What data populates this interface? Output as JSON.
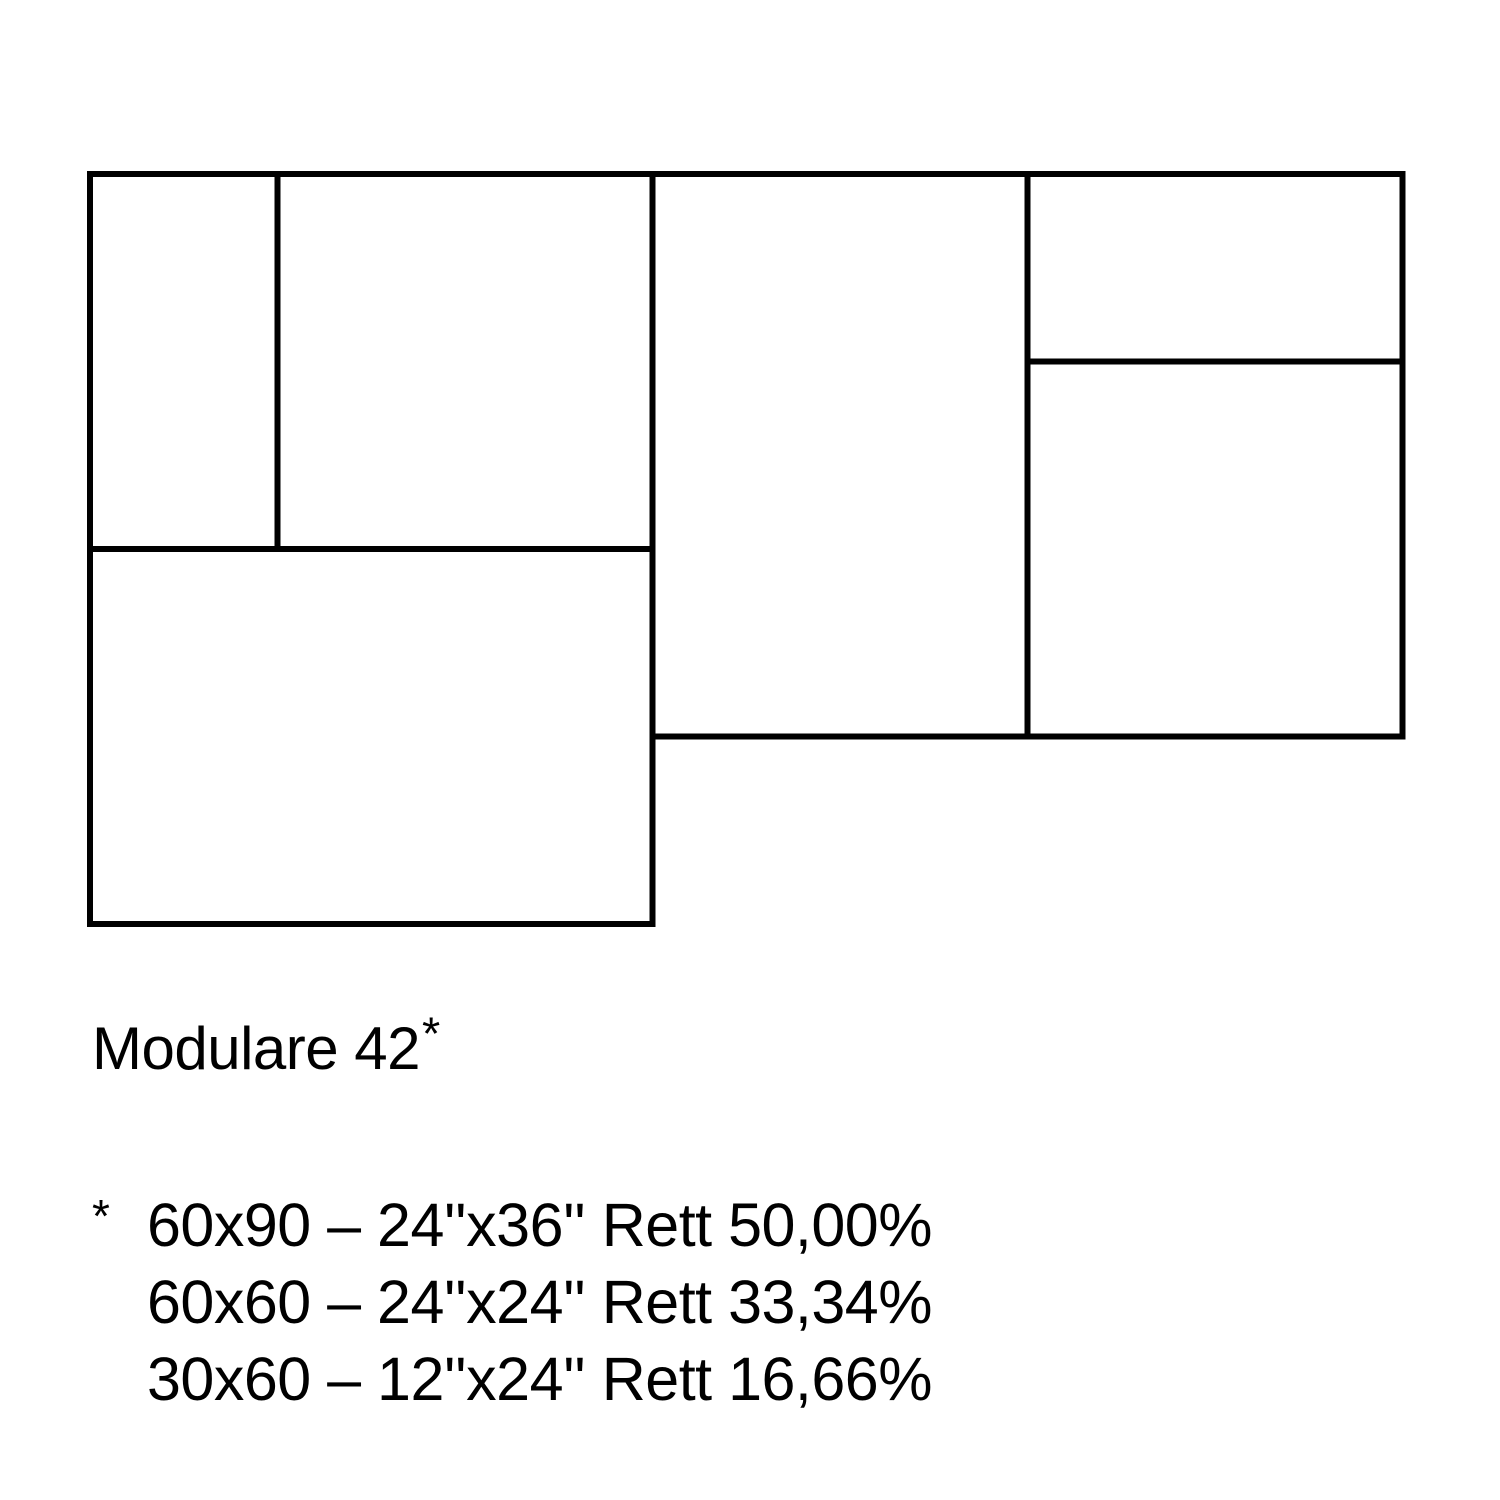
{
  "page": {
    "background_color": "#ffffff",
    "line_color": "#000000",
    "text_color": "#000000"
  },
  "title": {
    "text": "Modulare 42",
    "asterisk": "*"
  },
  "legend": {
    "marker": "*",
    "items": [
      {
        "text": "60x90 – 24''x36'' Rett 50,00%"
      },
      {
        "text": "60x60 – 24''x24'' Rett 33,34%"
      },
      {
        "text": "30x60 – 12''x24'' Rett 16,66%"
      }
    ]
  },
  "diagram": {
    "description": "Modulare 42 tile pattern module",
    "origin_px": {
      "x": 90,
      "y": 174
    },
    "unit_scale_px": 6.25,
    "stroke_width_px": 6,
    "tiles": [
      {
        "name": "tile-30x60-portrait",
        "size": "30x60",
        "x": 0,
        "y": 0,
        "w": 30,
        "h": 60
      },
      {
        "name": "tile-60x60-top-left",
        "size": "60x60",
        "x": 30,
        "y": 0,
        "w": 60,
        "h": 60
      },
      {
        "name": "tile-60x90-landscape",
        "size": "60x90",
        "x": 0,
        "y": 60,
        "w": 90,
        "h": 60
      },
      {
        "name": "tile-60x90-portrait",
        "size": "60x90",
        "x": 90,
        "y": 0,
        "w": 60,
        "h": 90
      },
      {
        "name": "tile-30x60-landscape",
        "size": "30x60",
        "x": 150,
        "y": 0,
        "w": 60,
        "h": 30
      },
      {
        "name": "tile-60x60-right",
        "size": "60x60",
        "x": 150,
        "y": 30,
        "w": 60,
        "h": 60
      }
    ]
  }
}
